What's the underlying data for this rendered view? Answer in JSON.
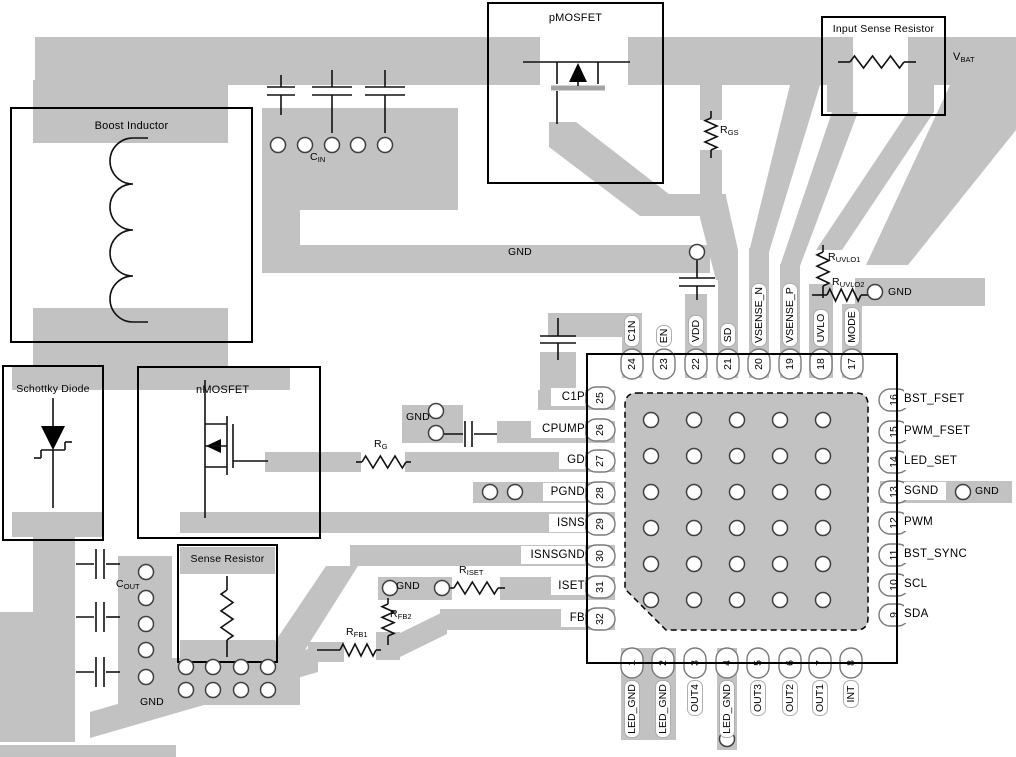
{
  "colors": {
    "trace": "#c2c2c2",
    "board": "#ffffff",
    "outline": "#000000"
  },
  "components": {
    "boost_inductor": "Boost Inductor",
    "pmosfet": "pMOSFET",
    "input_sense_resistor": "Input Sense Resistor",
    "schottky_diode": "Schottky Diode",
    "nmosfet": "nMOSFET",
    "sense_resistor": "Sense Resistor"
  },
  "nets": {
    "vbat": {
      "main": "V",
      "sub": "BAT"
    },
    "gnd": "GND"
  },
  "parts": {
    "cin": {
      "main": "C",
      "sub": "IN"
    },
    "cout": {
      "main": "C",
      "sub": "OUT"
    },
    "rgs": {
      "main": "R",
      "sub": "GS"
    },
    "ruvlo1": {
      "main": "R",
      "sub": "UVLO1"
    },
    "ruvlo2": {
      "main": "R",
      "sub": "UVLO2"
    },
    "rg": {
      "main": "R",
      "sub": "G"
    },
    "riset": {
      "main": "R",
      "sub": "ISET"
    },
    "rfb1": {
      "main": "R",
      "sub": "FB1"
    },
    "rfb2": {
      "main": "R",
      "sub": "FB2"
    }
  },
  "ic": {
    "pins_top": [
      {
        "number": "24",
        "label": "C1N"
      },
      {
        "number": "23",
        "label": "EN"
      },
      {
        "number": "22",
        "label": "VDD"
      },
      {
        "number": "21",
        "label": "SD"
      },
      {
        "number": "20",
        "label": "VSENSE_N"
      },
      {
        "number": "19",
        "label": "VSENSE_P"
      },
      {
        "number": "18",
        "label": "UVLO"
      },
      {
        "number": "17",
        "label": "MODE"
      }
    ],
    "pins_right": [
      {
        "number": "16",
        "label": "BST_FSET"
      },
      {
        "number": "15",
        "label": "PWM_FSET"
      },
      {
        "number": "14",
        "label": "LED_SET"
      },
      {
        "number": "13",
        "label": "SGND"
      },
      {
        "number": "12",
        "label": "PWM"
      },
      {
        "number": "11",
        "label": "BST_SYNC"
      },
      {
        "number": "10",
        "label": "SCL"
      },
      {
        "number": "9",
        "label": "SDA"
      }
    ],
    "pins_left": [
      {
        "number": "25",
        "label": "C1P"
      },
      {
        "number": "26",
        "label": "CPUMP"
      },
      {
        "number": "27",
        "label": "GD"
      },
      {
        "number": "28",
        "label": "PGND"
      },
      {
        "number": "29",
        "label": "ISNS"
      },
      {
        "number": "30",
        "label": "ISNSGND"
      },
      {
        "number": "31",
        "label": "ISET"
      },
      {
        "number": "32",
        "label": "FB"
      }
    ],
    "pins_bottom": [
      {
        "number": "1",
        "label": "LED_GND"
      },
      {
        "number": "2",
        "label": "LED_GND"
      },
      {
        "number": "3",
        "label": "OUT4"
      },
      {
        "number": "4",
        "label": "LED_GND"
      },
      {
        "number": "5",
        "label": "OUT3"
      },
      {
        "number": "6",
        "label": "OUT2"
      },
      {
        "number": "7",
        "label": "OUT1"
      },
      {
        "number": "8",
        "label": "INT"
      }
    ]
  }
}
